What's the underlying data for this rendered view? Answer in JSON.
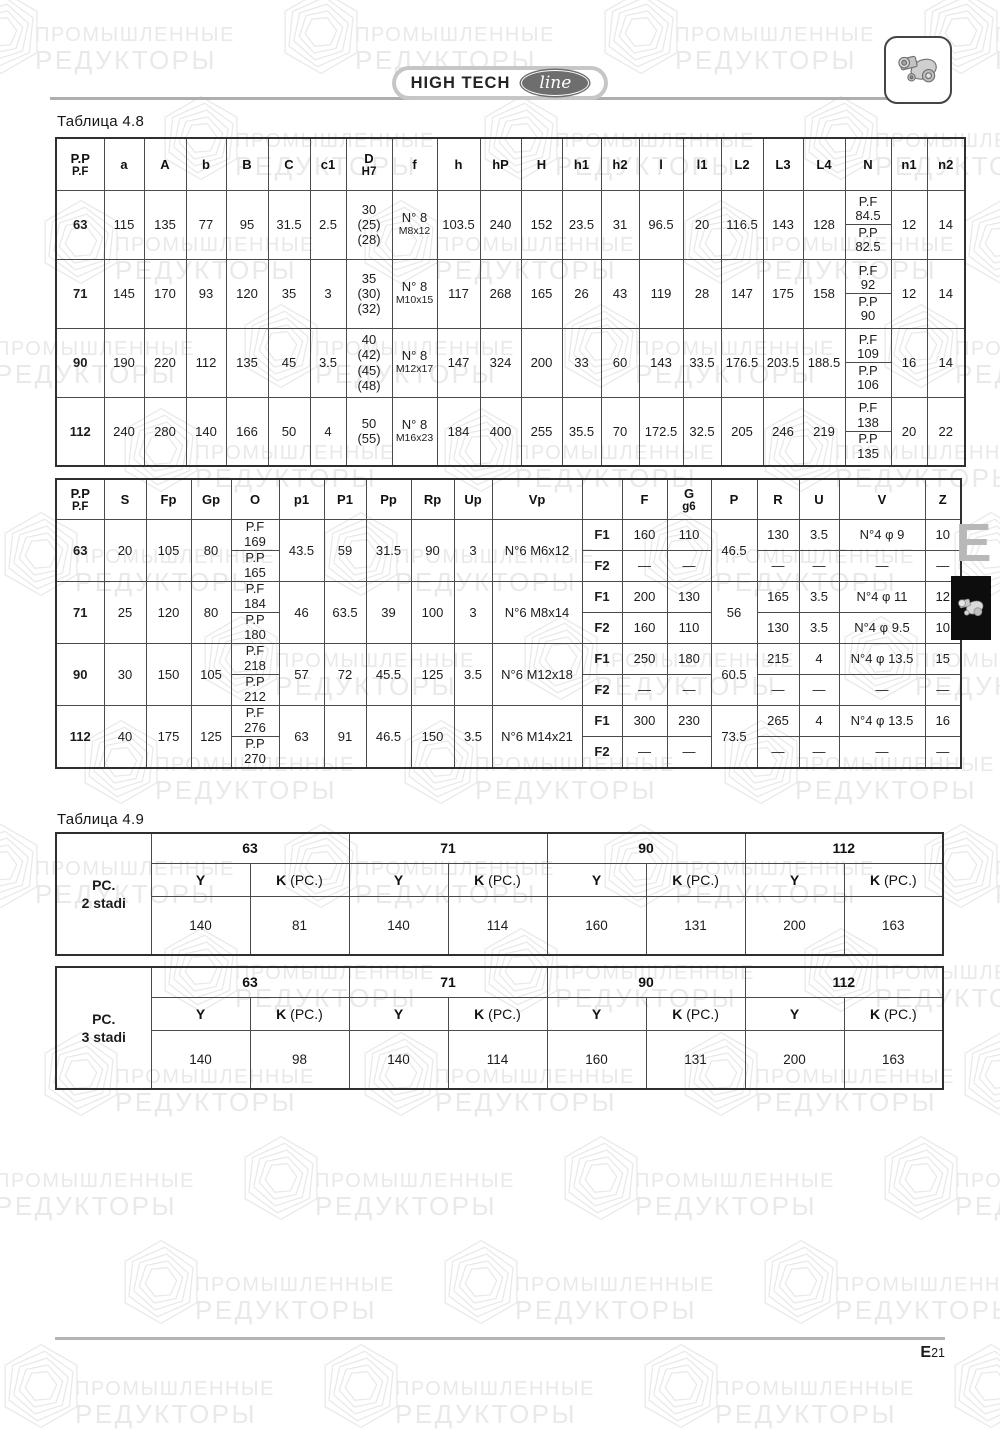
{
  "page": {
    "caption_48": "Таблица  4.8",
    "caption_49": "Таблица  4.9",
    "logo": {
      "brand": "HIGH TECH",
      "accent_word": "line"
    },
    "side_tab_letter": "E",
    "page_number": {
      "prefix": "E",
      "num": "21"
    },
    "watermark": {
      "line1": "ПРОМЫШЛЕННЫЕ",
      "line2": "РЕДУКТОРЫ"
    },
    "colors": {
      "table_border": "#4a4a4a",
      "outer_border": "#2f2f2f",
      "watermark": "#e9e9e9",
      "rule_gray": "#aeaeae",
      "pill_gray": "#c6c6c6",
      "line_badge": "#6e6e6e",
      "tab_letter": "#b8b8b8",
      "side_box": "#0d0d0d"
    }
  },
  "table48": {
    "headers": [
      [
        "P.P",
        "P.F"
      ],
      [
        "a"
      ],
      [
        "A"
      ],
      [
        "b"
      ],
      [
        "B"
      ],
      [
        "C"
      ],
      [
        "c1"
      ],
      [
        "D",
        "H7"
      ],
      [
        "f"
      ],
      [
        "h"
      ],
      [
        "hP"
      ],
      [
        "H"
      ],
      [
        "h1"
      ],
      [
        "h2"
      ],
      [
        "l"
      ],
      [
        "l1"
      ],
      [
        "L2"
      ],
      [
        "L3"
      ],
      [
        "L4"
      ],
      [
        "N"
      ],
      [
        "n1"
      ],
      [
        "n2"
      ]
    ],
    "rows": [
      {
        "size": "63",
        "a": "115",
        "A": "135",
        "b": "77",
        "B": "95",
        "C": "31.5",
        "c1": "2.5",
        "D": "30\n(25)\n(28)",
        "f_count": "N° 8",
        "f_thread": "M8x12",
        "h": "103.5",
        "hP": "240",
        "H": "152",
        "h1": "23.5",
        "h2": "31",
        "l": "96.5",
        "l1": "20",
        "L2": "116.5",
        "L3": "143",
        "L4": "128",
        "N_pf": "P.F\n84.5",
        "N_pp": "P.P\n82.5",
        "n1": "12",
        "n2": "14"
      },
      {
        "size": "71",
        "a": "145",
        "A": "170",
        "b": "93",
        "B": "120",
        "C": "35",
        "c1": "3",
        "D": "35\n(30)\n(32)",
        "f_count": "N° 8",
        "f_thread": "M10x15",
        "h": "117",
        "hP": "268",
        "H": "165",
        "h1": "26",
        "h2": "43",
        "l": "119",
        "l1": "28",
        "L2": "147",
        "L3": "175",
        "L4": "158",
        "N_pf": "P.F\n92",
        "N_pp": "P.P\n90",
        "n1": "12",
        "n2": "14"
      },
      {
        "size": "90",
        "a": "190",
        "A": "220",
        "b": "112",
        "B": "135",
        "C": "45",
        "c1": "3.5",
        "D": "40\n(42)\n(45)\n(48)",
        "f_count": "N° 8",
        "f_thread": "M12x17",
        "h": "147",
        "hP": "324",
        "H": "200",
        "h1": "33",
        "h2": "60",
        "l": "143",
        "l1": "33.5",
        "L2": "176.5",
        "L3": "203.5",
        "L4": "188.5",
        "N_pf": "P.F\n109",
        "N_pp": "P.P\n106",
        "n1": "16",
        "n2": "14"
      },
      {
        "size": "112",
        "a": "240",
        "A": "280",
        "b": "140",
        "B": "166",
        "C": "50",
        "c1": "4",
        "D": "50\n(55)",
        "f_count": "N° 8",
        "f_thread": "M16x23",
        "h": "184",
        "hP": "400",
        "H": "255",
        "h1": "35.5",
        "h2": "70",
        "l": "172.5",
        "l1": "32.5",
        "L2": "205",
        "L3": "246",
        "L4": "219",
        "N_pf": "P.F\n138",
        "N_pp": "P.P\n135",
        "n1": "20",
        "n2": "22"
      }
    ]
  },
  "table48b": {
    "headers": [
      [
        "P.P",
        "P.F"
      ],
      [
        "S"
      ],
      [
        "Fp"
      ],
      [
        "Gp"
      ],
      [
        "O"
      ],
      [
        "p1"
      ],
      [
        "P1"
      ],
      [
        "Pp"
      ],
      [
        "Rp"
      ],
      [
        "Up"
      ],
      [
        "Vp"
      ],
      [
        ""
      ],
      [
        "F"
      ],
      [
        "G",
        "g6"
      ],
      [
        "P"
      ],
      [
        "R"
      ],
      [
        "U"
      ],
      [
        "V"
      ],
      [
        "Z"
      ]
    ],
    "f_labels": [
      "F1",
      "F2"
    ],
    "rows": [
      {
        "size": "63",
        "S": "20",
        "Fp": "105",
        "Gp": "80",
        "O_pf": "P.F\n169",
        "O_pp": "P.P\n165",
        "p1": "43.5",
        "P1": "59",
        "Pp": "31.5",
        "Rp": "90",
        "Up": "3",
        "Vp": "N°6 M6x12",
        "P": "46.5",
        "F1": {
          "F": "160",
          "G": "110",
          "R": "130",
          "U": "3.5",
          "V": "N°4 φ 9",
          "Z": "10"
        },
        "F2": {
          "F": "—",
          "G": "—",
          "R": "—",
          "U": "—",
          "V": "—",
          "Z": "—"
        }
      },
      {
        "size": "71",
        "S": "25",
        "Fp": "120",
        "Gp": "80",
        "O_pf": "P.F\n184",
        "O_pp": "P.P\n180",
        "p1": "46",
        "P1": "63.5",
        "Pp": "39",
        "Rp": "100",
        "Up": "3",
        "Vp": "N°6 M8x14",
        "P": "56",
        "F1": {
          "F": "200",
          "G": "130",
          "R": "165",
          "U": "3.5",
          "V": "N°4 φ 11",
          "Z": "12"
        },
        "F2": {
          "F": "160",
          "G": "110",
          "R": "130",
          "U": "3.5",
          "V": "N°4 φ 9.5",
          "Z": "10"
        }
      },
      {
        "size": "90",
        "S": "30",
        "Fp": "150",
        "Gp": "105",
        "O_pf": "P.F\n218",
        "O_pp": "P.P\n212",
        "p1": "57",
        "P1": "72",
        "Pp": "45.5",
        "Rp": "125",
        "Up": "3.5",
        "Vp": "N°6 M12x18",
        "P": "60.5",
        "F1": {
          "F": "250",
          "G": "180",
          "R": "215",
          "U": "4",
          "V": "N°4 φ 13.5",
          "Z": "15"
        },
        "F2": {
          "F": "—",
          "G": "—",
          "R": "—",
          "U": "—",
          "V": "—",
          "Z": "—"
        }
      },
      {
        "size": "112",
        "S": "40",
        "Fp": "175",
        "Gp": "125",
        "O_pf": "P.F\n276",
        "O_pp": "P.P\n270",
        "p1": "63",
        "P1": "91",
        "Pp": "46.5",
        "Rp": "150",
        "Up": "3.5",
        "Vp": "N°6 M14x21",
        "P": "73.5",
        "F1": {
          "F": "300",
          "G": "230",
          "R": "265",
          "U": "4",
          "V": "N°4 φ 13.5",
          "Z": "16"
        },
        "F2": {
          "F": "—",
          "G": "—",
          "R": "—",
          "U": "—",
          "V": "—",
          "Z": "—"
        }
      }
    ]
  },
  "table49": {
    "sizes": [
      "63",
      "71",
      "90",
      "112"
    ],
    "y_label": "Y",
    "k_label": "K",
    "k_suffix": " (PC.)",
    "tables": [
      {
        "label_line1": "PC.",
        "label_line2": "2 stadi",
        "values": [
          [
            "140",
            "81"
          ],
          [
            "140",
            "114"
          ],
          [
            "160",
            "131"
          ],
          [
            "200",
            "163"
          ]
        ]
      },
      {
        "label_line1": "PC.",
        "label_line2": "3 stadi",
        "values": [
          [
            "140",
            "98"
          ],
          [
            "140",
            "114"
          ],
          [
            "160",
            "131"
          ],
          [
            "200",
            "163"
          ]
        ]
      }
    ]
  }
}
